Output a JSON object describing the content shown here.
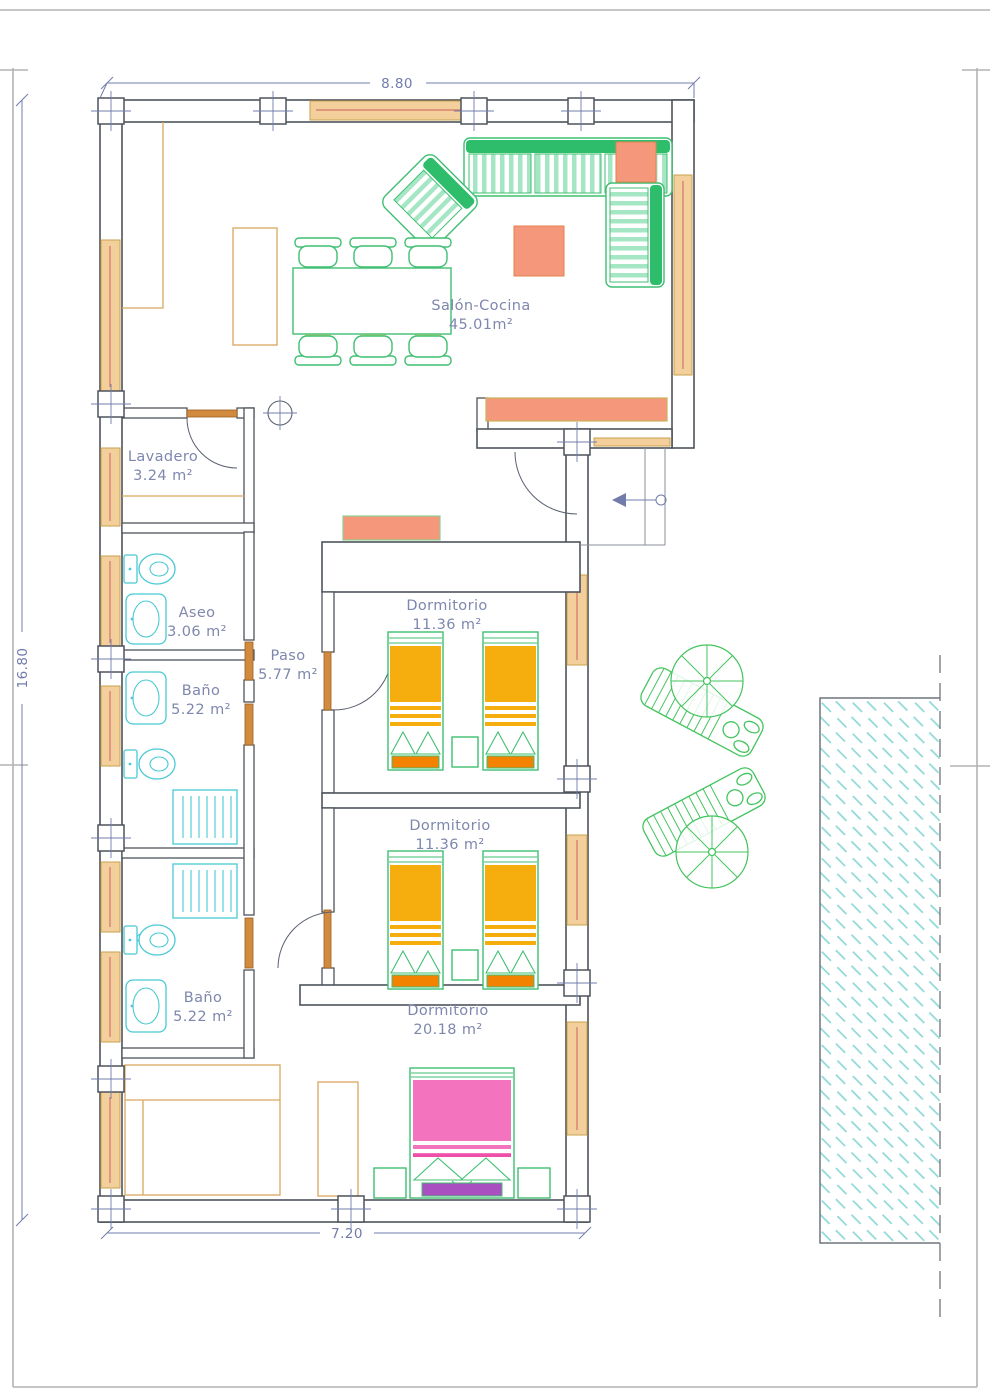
{
  "plan": {
    "rooms": [
      {
        "name": "Salón-Cocina",
        "area": "45.01m²"
      },
      {
        "name": "Lavadero",
        "area": "3.24 m²"
      },
      {
        "name": "Aseo",
        "area": "3.06 m²"
      },
      {
        "name": "Paso",
        "area": "5.77 m²"
      },
      {
        "name": "Baño",
        "area": "5.22 m²"
      },
      {
        "name": "Dormitorio",
        "area": "11.36 m²"
      },
      {
        "name": "Dormitorio",
        "area": "11.36 m²"
      },
      {
        "name": "Baño",
        "area": "5.22 m²"
      },
      {
        "name": "Dormitorio",
        "area": "20.18 m²"
      }
    ],
    "dimensions": {
      "top": "8.80",
      "left": "16.80",
      "bottom": "7.20"
    },
    "colors": {
      "wall": "#4e545c",
      "dimension_text": "#717cab",
      "label_text": "#7e87ae",
      "window_tan": "#f2cf9b",
      "furniture_green": "#3fbf72",
      "sofa_band_green": "#2ebd6b",
      "stripe_light_green": "#a5e7c4",
      "salmon": "#f5977a",
      "bed_amber": "#f6ad0e",
      "bed_footer_orange": "#f28200",
      "chair_yellow": "#f7d77d",
      "double_bed_pink": "#f473be",
      "double_bed_purple": "#a94fc0",
      "sanitary_cyan": "#49c9d4",
      "pool_hatch_cyan": "#8fd8d8"
    }
  }
}
